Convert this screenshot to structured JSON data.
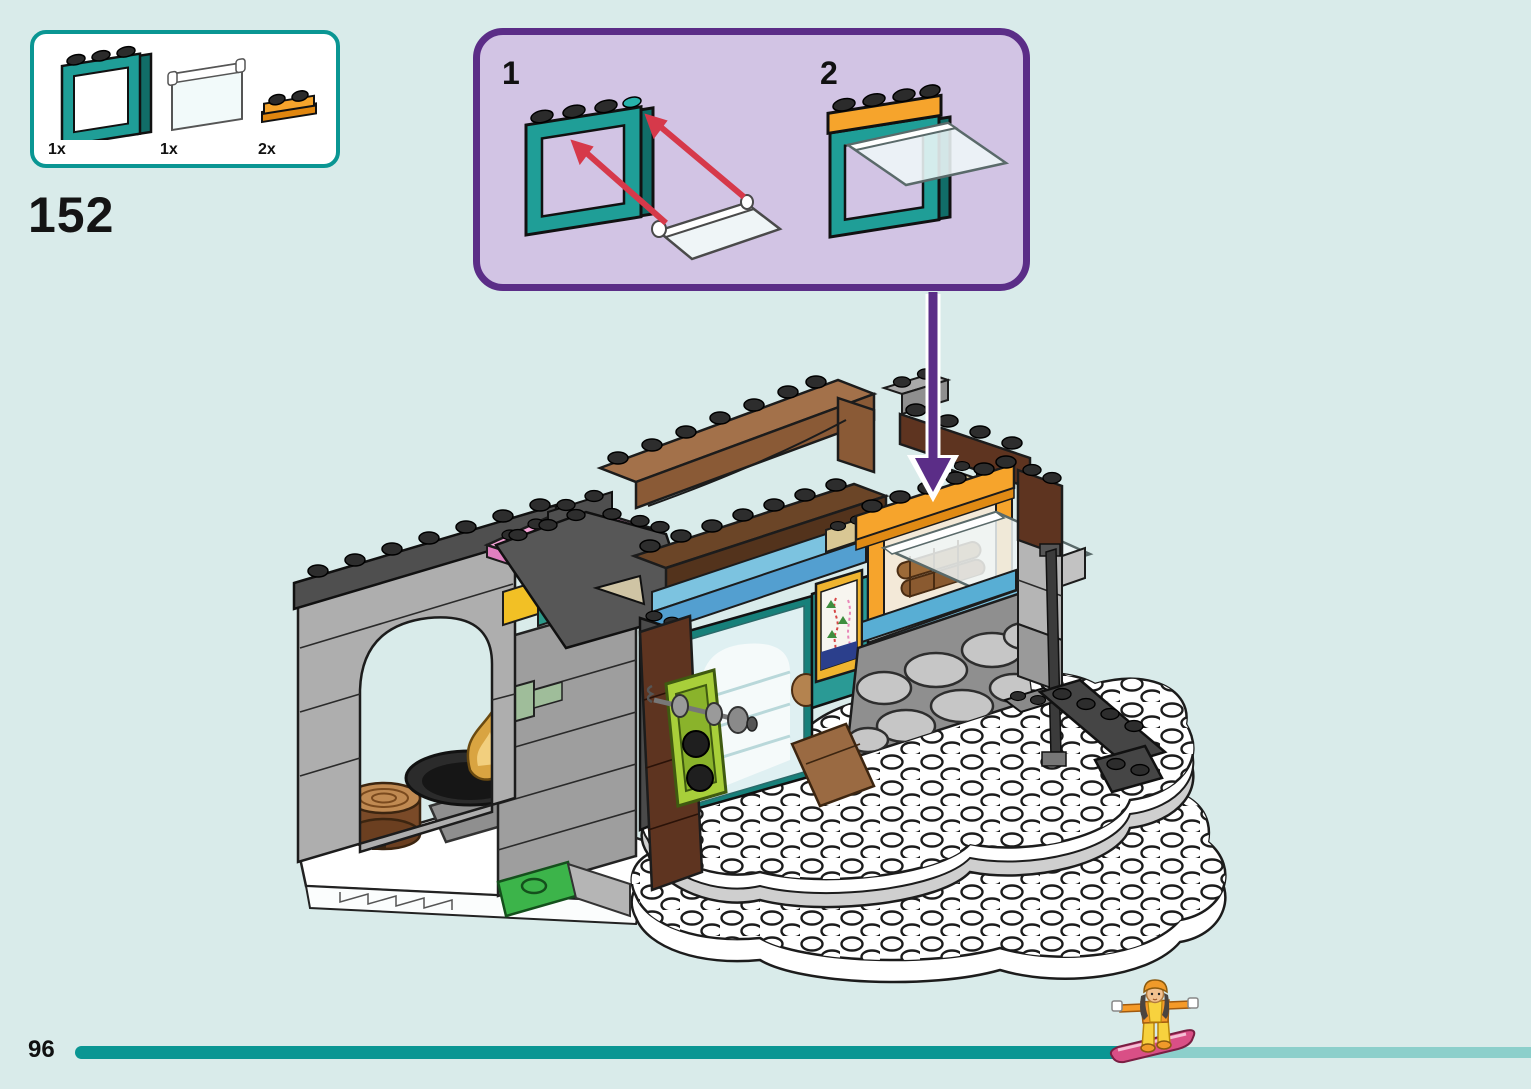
{
  "theme": {
    "background": "#d9ebea",
    "teal": "#0a9693",
    "purple": "#5b2d87",
    "callout_bg": "#d2c4e4",
    "bar_rest": "#8ccfcb",
    "arrow_red": "#d6394a"
  },
  "step": {
    "number": "152"
  },
  "parts_panel": {
    "parts": [
      {
        "name": "window-frame-1x4x3-dark-turquoise",
        "count": "1x",
        "color": "#1f9e97"
      },
      {
        "name": "window-pane-1x4x3-transparent",
        "count": "1x",
        "color": "#eef7f7"
      },
      {
        "name": "plate-1x2-with-door-rail-bright-orange",
        "count": "2x",
        "color": "#f6a42c"
      }
    ]
  },
  "callout": {
    "steps": [
      {
        "label": "1"
      },
      {
        "label": "2"
      }
    ]
  },
  "model": {
    "components": [
      "stone-arch-wall",
      "pink-roof-plate",
      "brown-attic-beam",
      "stone-chimney",
      "fire-bowl-with-flame",
      "wood-stump",
      "lime-dumbbell-rack",
      "glass-door",
      "ski-map-poster",
      "orange-shop-window-open",
      "azure-window-sill",
      "cobblestone-wall",
      "snow-baseplate-terraces",
      "dark-step-plates",
      "green-brick"
    ]
  },
  "footer": {
    "page_number": "96",
    "progress_marker": "snowboarder-minidoll"
  }
}
